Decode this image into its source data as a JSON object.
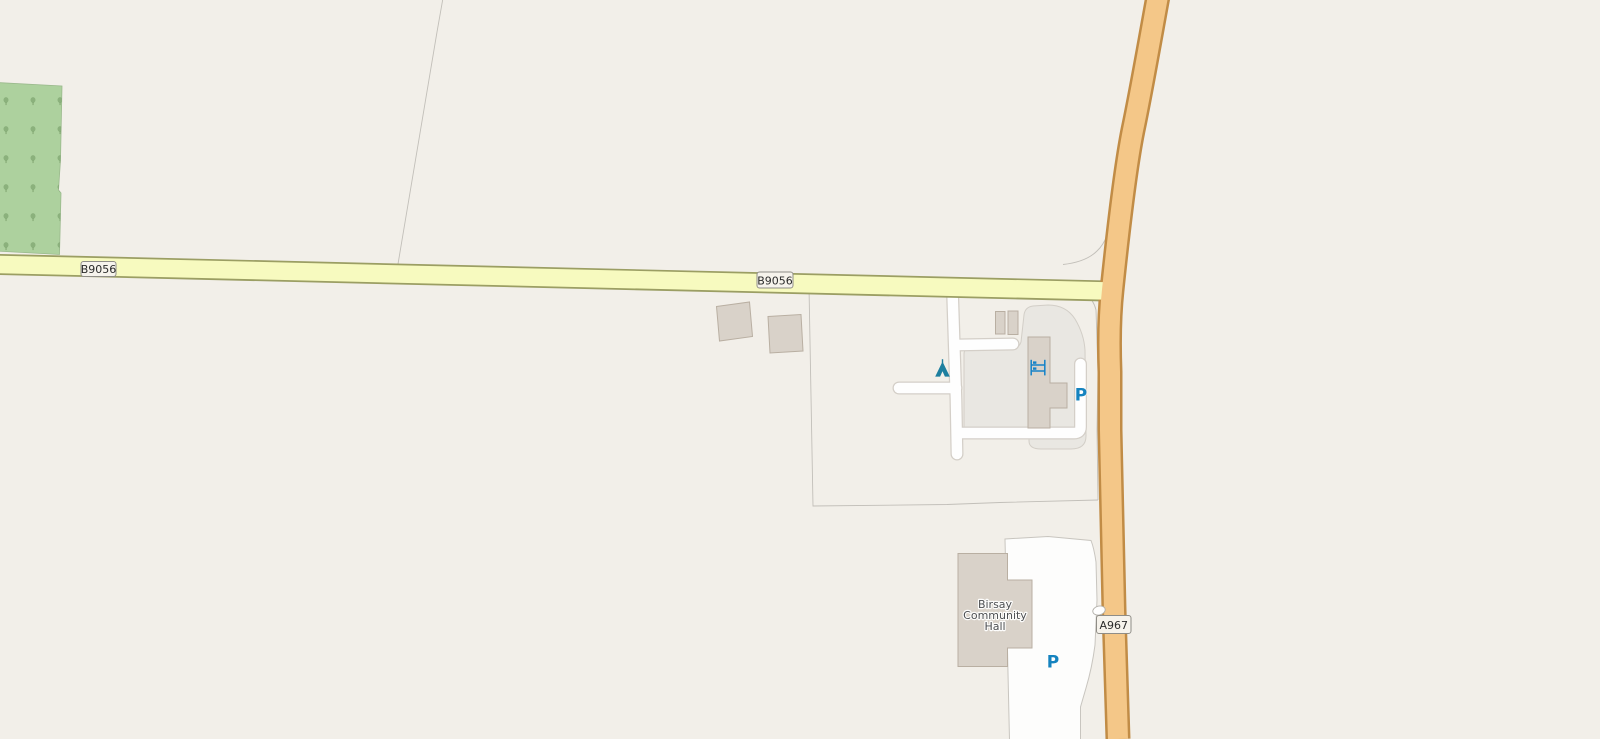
{
  "map": {
    "background_color": "#f2efe9",
    "roads": {
      "b9056": {
        "ref": "B9056",
        "fill": "#f7fabf",
        "casing": "#9b9e63"
      },
      "a967": {
        "ref": "A967",
        "fill": "#f4c788",
        "casing": "#c18c46"
      },
      "service": {
        "fill": "#fefefe",
        "casing": "#d4cfc8"
      }
    },
    "areas": {
      "forest": {
        "fill": "#add19e",
        "tree_color": "#6f9760"
      },
      "buildings": {
        "fill": "#d9d2c9",
        "stroke": "#b9afa2"
      },
      "parking_lot": {
        "fill": "#e9e7e2",
        "stroke": "#d2cec7"
      },
      "hall_grounds": {
        "fill": "#fdfdfc",
        "stroke": "#c8c5bf"
      },
      "field_boundary_color": "#c2bfb9"
    },
    "poi": {
      "campsite": {
        "color": "#1d7f9f"
      },
      "hostel": {
        "color": "#1482c8"
      },
      "parking_north": {
        "letter": "P",
        "color": "#1583bf"
      },
      "parking_south": {
        "letter": "P",
        "color": "#1583bf"
      }
    },
    "labels": {
      "hall": {
        "line1": "Birsay",
        "line2": "Community",
        "line3": "Hall",
        "color": "#4d4f52"
      },
      "shield": {
        "fill": "#f6f3ec",
        "stroke": "#8f8d87",
        "text_color": "#2b2b2b"
      }
    }
  }
}
